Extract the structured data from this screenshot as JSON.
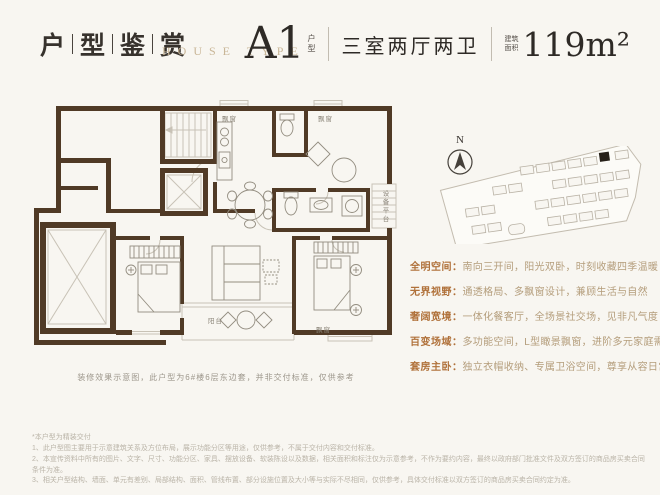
{
  "header": {
    "title_chars": [
      "户",
      "型",
      "鉴",
      "赏"
    ],
    "subtitle": "HOUSE TYPE"
  },
  "unit": {
    "name": "A1",
    "name_tag": "户型",
    "rooms": "三室两厅两卫",
    "area_tag_line1": "建筑",
    "area_tag_line2": "面积",
    "area": "119m²"
  },
  "floorplan": {
    "labels": {
      "bay_top_left": "飘窗",
      "bay_top_right": "飘窗",
      "equipment_platform": "设备平台",
      "balcony": "阳台",
      "bay_bottom_right": "飘窗"
    },
    "caption": "装修效果示意图，此户型为6#楼6层东边套，并非交付标准，仅供参考"
  },
  "compass": {
    "label": "N"
  },
  "features": [
    {
      "label": "全明空间：",
      "text": "南向三开间，阳光双卧，时刻收藏四季温暖"
    },
    {
      "label": "无界视野：",
      "text": "通透格局、多飘窗设计，兼顾生活与自然"
    },
    {
      "label": "奢阔宽境：",
      "text": "一体化餐客厅，全场景社交场，见非凡气度"
    },
    {
      "label": "百变场域：",
      "text": "多功能空间，L型瞰景飘窗，进阶多元家庭需求"
    },
    {
      "label": "套房主卧：",
      "text": "独立衣帽收纳、专属卫浴空间，尊享从容日常"
    }
  ],
  "disclaimer": {
    "note": "*本户型为精装交付",
    "items": [
      "1、此户型图主要用于示意建筑关系及方位布局，展示功能分区等用途，仅供参考，不属于交付内容和交付标准。",
      "2、本宣传资料中所有的图片、文字、尺寸、功能分区、家具、摆放设备、软装陈设以及数据，相关面积和标注仅为示意参考，不作为要约内容，最终以政府部门批准文件及双方签订的商品房买卖合同条件为准。",
      "3、相关户型结构、墙面、单元有差别、局部结构、面积、管线布置、部分设施位置及大小等与实际不尽相同，仅供参考，具体交付标准以双方签订的商品房买卖合同约定为准。"
    ]
  },
  "colors": {
    "accent_gold": "#c9b697",
    "feature_label": "#b0713a",
    "wall_brown": "#503a26",
    "background": "#f8f6f1"
  }
}
